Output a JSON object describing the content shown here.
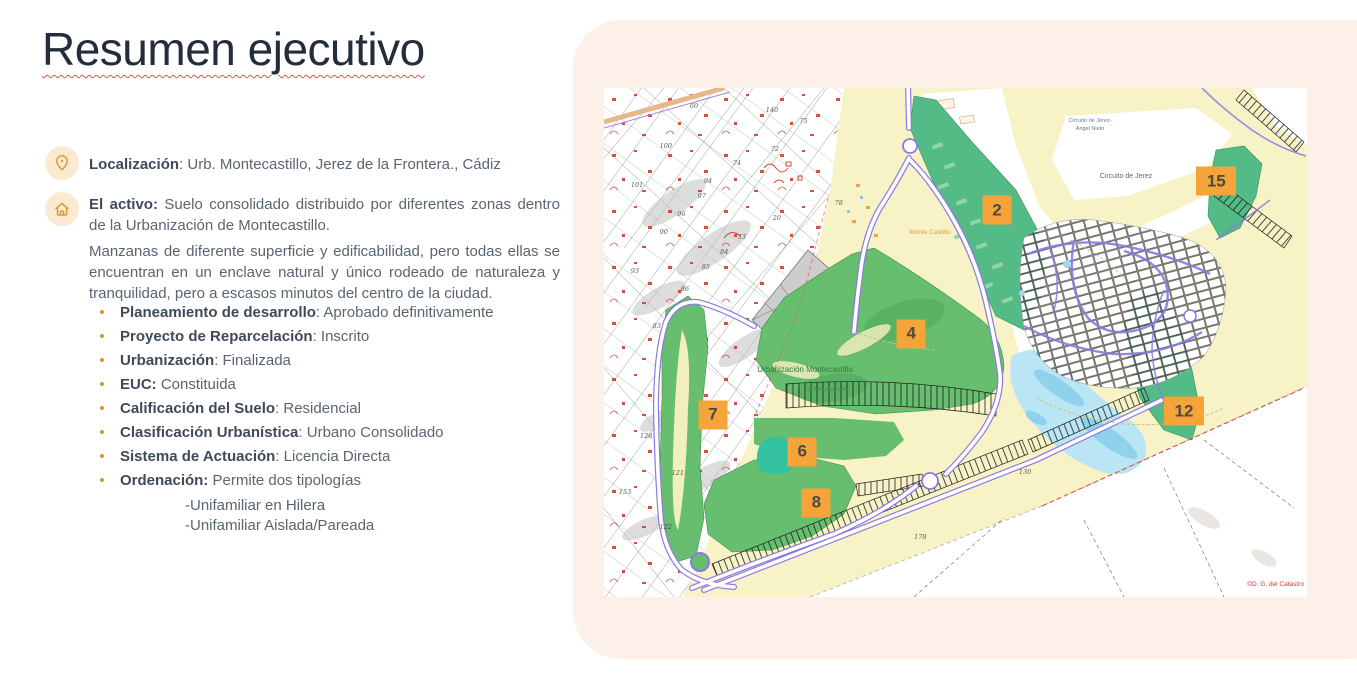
{
  "slide": {
    "title": "Resumen ejecutivo",
    "location": {
      "label": "Localización",
      "value": ": Urb. Montecastillo, Jerez de la Frontera., Cádiz"
    },
    "asset": {
      "label": "El activo:",
      "value": " Suelo consolidado distribuido por diferentes zonas dentro de la Urbanización de Montecastillo.",
      "paragraph2": "Manzanas de diferente superficie y edificabilidad, pero todas ellas se encuentran en un enclave natural y único rodeado de naturaleza y tranquilidad, pero a escasos minutos del centro de la ciudad."
    },
    "bullets": [
      {
        "label": "Planeamiento de desarrollo",
        "value": ": Aprobado definitivamente"
      },
      {
        "label": "Proyecto de Reparcelación",
        "value": ": Inscrito"
      },
      {
        "label": "Urbanización",
        "value": ": Finalizada"
      },
      {
        "label": "EUC:",
        "value": " Constituida"
      },
      {
        "label": "Calificación del Suelo",
        "value": ": Residencial"
      },
      {
        "label": "Clasificación Urbanística",
        "value": ": Urbano Consolidado"
      },
      {
        "label": "Sistema de Actuación",
        "value": ": Licencia Directa"
      },
      {
        "label": "Ordenación:",
        "value": " Permite dos tipologías"
      }
    ],
    "sub_bullets": [
      "-Unifamiliar en Hilera",
      "-Unifamiliar Aislada/Pareada"
    ]
  },
  "map": {
    "labels": {
      "circuit_line1": "Circuito de Jérez-",
      "circuit_line2": "Angel Nieto",
      "circuit2": "Circuito de Jerez",
      "monte": "Monte Castillo",
      "urbanizacion": "Urbanización Montecastillo",
      "golf": "Golf Montecastillo",
      "copyright": "©D. G. del Catastro"
    },
    "markers": [
      {
        "label": "2",
        "x": 55.9,
        "y": 24.0,
        "wide": false
      },
      {
        "label": "15",
        "x": 87.1,
        "y": 18.3,
        "wide": true
      },
      {
        "label": "4",
        "x": 43.7,
        "y": 48.3,
        "wide": false
      },
      {
        "label": "7",
        "x": 15.5,
        "y": 64.2,
        "wide": false
      },
      {
        "label": "6",
        "x": 28.2,
        "y": 71.5,
        "wide": false
      },
      {
        "label": "8",
        "x": 30.2,
        "y": 81.5,
        "wide": false
      },
      {
        "label": "12",
        "x": 82.5,
        "y": 63.5,
        "wide": true
      }
    ],
    "parcel_numbers": [
      {
        "n": "60",
        "x": 12.8,
        "y": 3.5
      },
      {
        "n": "140",
        "x": 23.9,
        "y": 4.3
      },
      {
        "n": "100",
        "x": 8.8,
        "y": 11.4
      },
      {
        "n": "75",
        "x": 28.4,
        "y": 6.5
      },
      {
        "n": "72",
        "x": 24.3,
        "y": 12.0
      },
      {
        "n": "74",
        "x": 18.9,
        "y": 14.7
      },
      {
        "n": "101",
        "x": 4.7,
        "y": 19.1
      },
      {
        "n": "94",
        "x": 14.8,
        "y": 18.3
      },
      {
        "n": "97",
        "x": 13.9,
        "y": 21.2
      },
      {
        "n": "96",
        "x": 11.0,
        "y": 24.8
      },
      {
        "n": "90",
        "x": 8.5,
        "y": 28.3
      },
      {
        "n": "33",
        "x": 19.6,
        "y": 29.3
      },
      {
        "n": "20",
        "x": 24.6,
        "y": 25.5
      },
      {
        "n": "78",
        "x": 33.4,
        "y": 22.6
      },
      {
        "n": "93",
        "x": 4.4,
        "y": 36.0
      },
      {
        "n": "85",
        "x": 14.5,
        "y": 35.2
      },
      {
        "n": "84",
        "x": 17.1,
        "y": 32.2
      },
      {
        "n": "86",
        "x": 11.5,
        "y": 39.5
      },
      {
        "n": "83",
        "x": 7.5,
        "y": 46.8
      },
      {
        "n": "128",
        "x": 6.0,
        "y": 68.4
      },
      {
        "n": "121",
        "x": 10.5,
        "y": 75.6
      },
      {
        "n": "153",
        "x": 3.0,
        "y": 79.4
      },
      {
        "n": "122",
        "x": 8.8,
        "y": 86.2
      },
      {
        "n": "130",
        "x": 59.9,
        "y": 75.4
      },
      {
        "n": "178",
        "x": 45.0,
        "y": 88.2
      }
    ]
  },
  "banner": {
    "text": "MANZANA – 12  UE.10,12,13.  MONTECASTILLO"
  },
  "colors": {
    "accent_orange": "#E8940C",
    "marker_orange": "#F5A43A",
    "panel_bg": "#FCF0E8",
    "title_color": "#232D3B",
    "body_text": "#5A6572",
    "bold_text": "#3F4A5A",
    "bullet_dot": "#D99A2B",
    "underline_red": "#E0554A",
    "map_yellow": "#F8F3C6",
    "map_green_leaf": "#66BE6E",
    "map_green_emerald": "#54BB86",
    "map_lake": "#B9E5F4",
    "map_road_purple": "#8B7AE0"
  }
}
